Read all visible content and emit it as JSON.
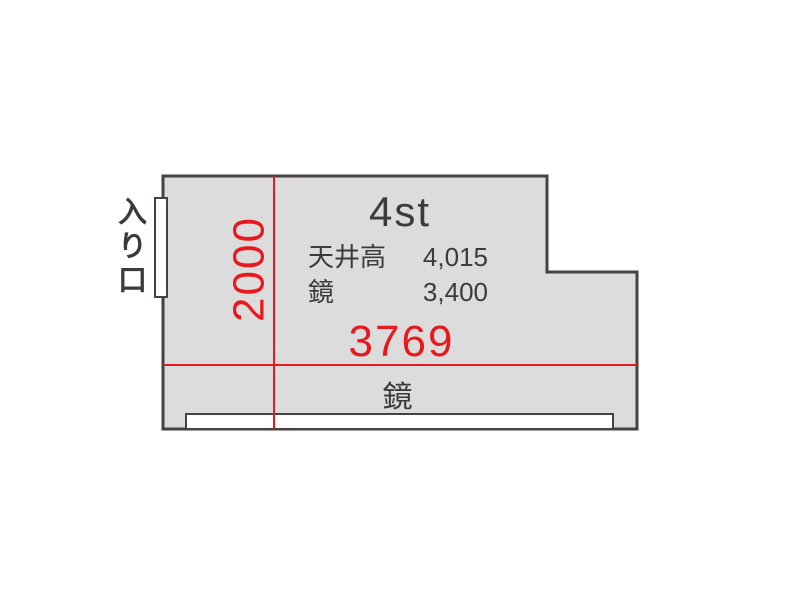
{
  "palette": {
    "room_fill": "#dcdcdc",
    "wall": "#474140",
    "red": "#e8191c",
    "text": "#3e3a39",
    "white": "#ffffff"
  },
  "floorplan": {
    "room_title": "4st",
    "entrance_label": "入り口",
    "specs": [
      {
        "label": "天井高",
        "value": "4,015"
      },
      {
        "label": "鏡",
        "value": "3,400"
      }
    ],
    "width_dimension": "3769",
    "height_dimension": "2000",
    "mirror_label": "鏡"
  }
}
